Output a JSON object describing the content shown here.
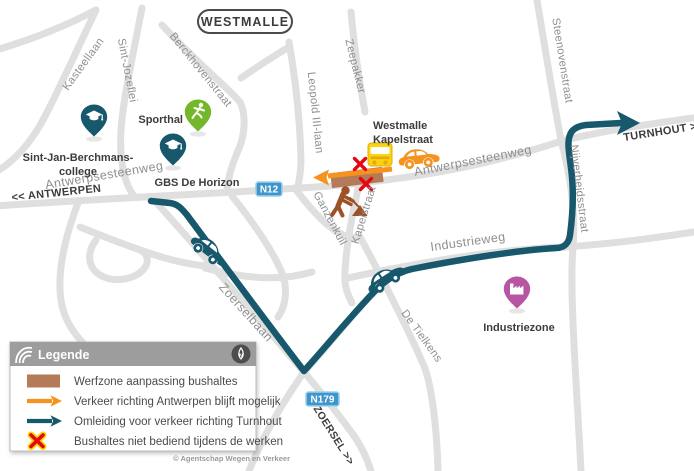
{
  "region_label": "WESTMALLE",
  "streets": {
    "kasteellaan": "Kasteellaan",
    "sint_jozeflei": "Sint-Jozeflei",
    "berckhovenstraat": "Berckhovenstraat",
    "zeepakker": "Zeepakker",
    "leopold_iii_laan": "Leopold III-laan",
    "steenovenstraat": "Steenovenstraat",
    "nijverheidsstraat": "Nijverheidsstraat",
    "antwerpsesteenweg_west": "Antwerpsesteenweg",
    "antwerpsesteenweg_east": "Antwerpsesteenweg",
    "ganzenkuil": "Ganzenkuil",
    "kapelstraat": "Kapelstraat",
    "zoerselbaan": "Zoerselbaan",
    "industrieweg": "Industrieweg",
    "de_tielkens": "De Tielkens"
  },
  "directions": {
    "antwerpen": "<< ANTWERPEN",
    "turnhout": "TURNHOUT >>",
    "zoersel": "ZOERSEL >>"
  },
  "road_shields": {
    "n12": "N12",
    "n179": "N179"
  },
  "pois": {
    "sporthal": "Sporthal",
    "college_line1": "Sint-Jan-Berchmans-",
    "college_line2": "college",
    "gbs": "GBS De Horizon",
    "industriezone": "Industriezone",
    "bus_stop_line1": "Westmalle",
    "bus_stop_line2": "Kapelstraat"
  },
  "legend": {
    "title": "Legende",
    "compass_label": "N",
    "items": [
      {
        "icon": "werfzone-swatch",
        "label": "Werfzone aanpassing bushaltes"
      },
      {
        "icon": "orange-arrow",
        "label": "Verkeer richting Antwerpen blijft mogelijk"
      },
      {
        "icon": "teal-arrow",
        "label": "Omleiding voor verkeer richting Turnhout"
      },
      {
        "icon": "red-x",
        "label": "Bushaltes niet bediend tijdens de werken"
      }
    ]
  },
  "copyright": "© Agentschap Wegen en Verkeer",
  "colors": {
    "road_gray": "#dfdfdf",
    "street_label_gray": "#8f8f8f",
    "dark_text": "#3c3c3c",
    "detour_teal": "#17586c",
    "traffic_orange": "#f6921e",
    "werfzone_brown": "#b57a58",
    "closed_red": "#e30613",
    "sport_pin_green": "#74b72a",
    "industry_pin_magenta": "#b755a2",
    "bus_yellow": "#f8d411",
    "shield_blue": "#3e96cb",
    "legend_header_gray": "#9d9d9d"
  }
}
